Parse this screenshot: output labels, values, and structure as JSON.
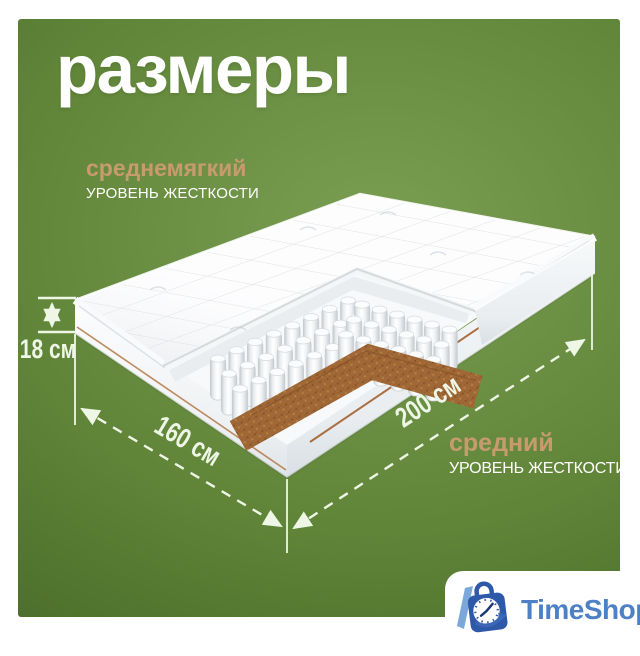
{
  "title": "размеры",
  "firmness_top": {
    "level": "среднемягкий",
    "caption": "УРОВЕНЬ ЖЕСТКОСТИ"
  },
  "firmness_bottom": {
    "level": "средний",
    "caption": "УРОВЕНЬ ЖЕСТКОСТИ"
  },
  "dimensions": {
    "height": "18 см",
    "width": "160 см",
    "length": "200 см"
  },
  "logo": {
    "text": "TimeShop"
  },
  "colors": {
    "panel_green": "#628639",
    "accent_tan": "#c79b6e",
    "dimension_white": "#eef6e6",
    "coir_brown": "#9b6130",
    "logo_blue": "#4d80c4",
    "bag_blue": "#2e59a8"
  }
}
